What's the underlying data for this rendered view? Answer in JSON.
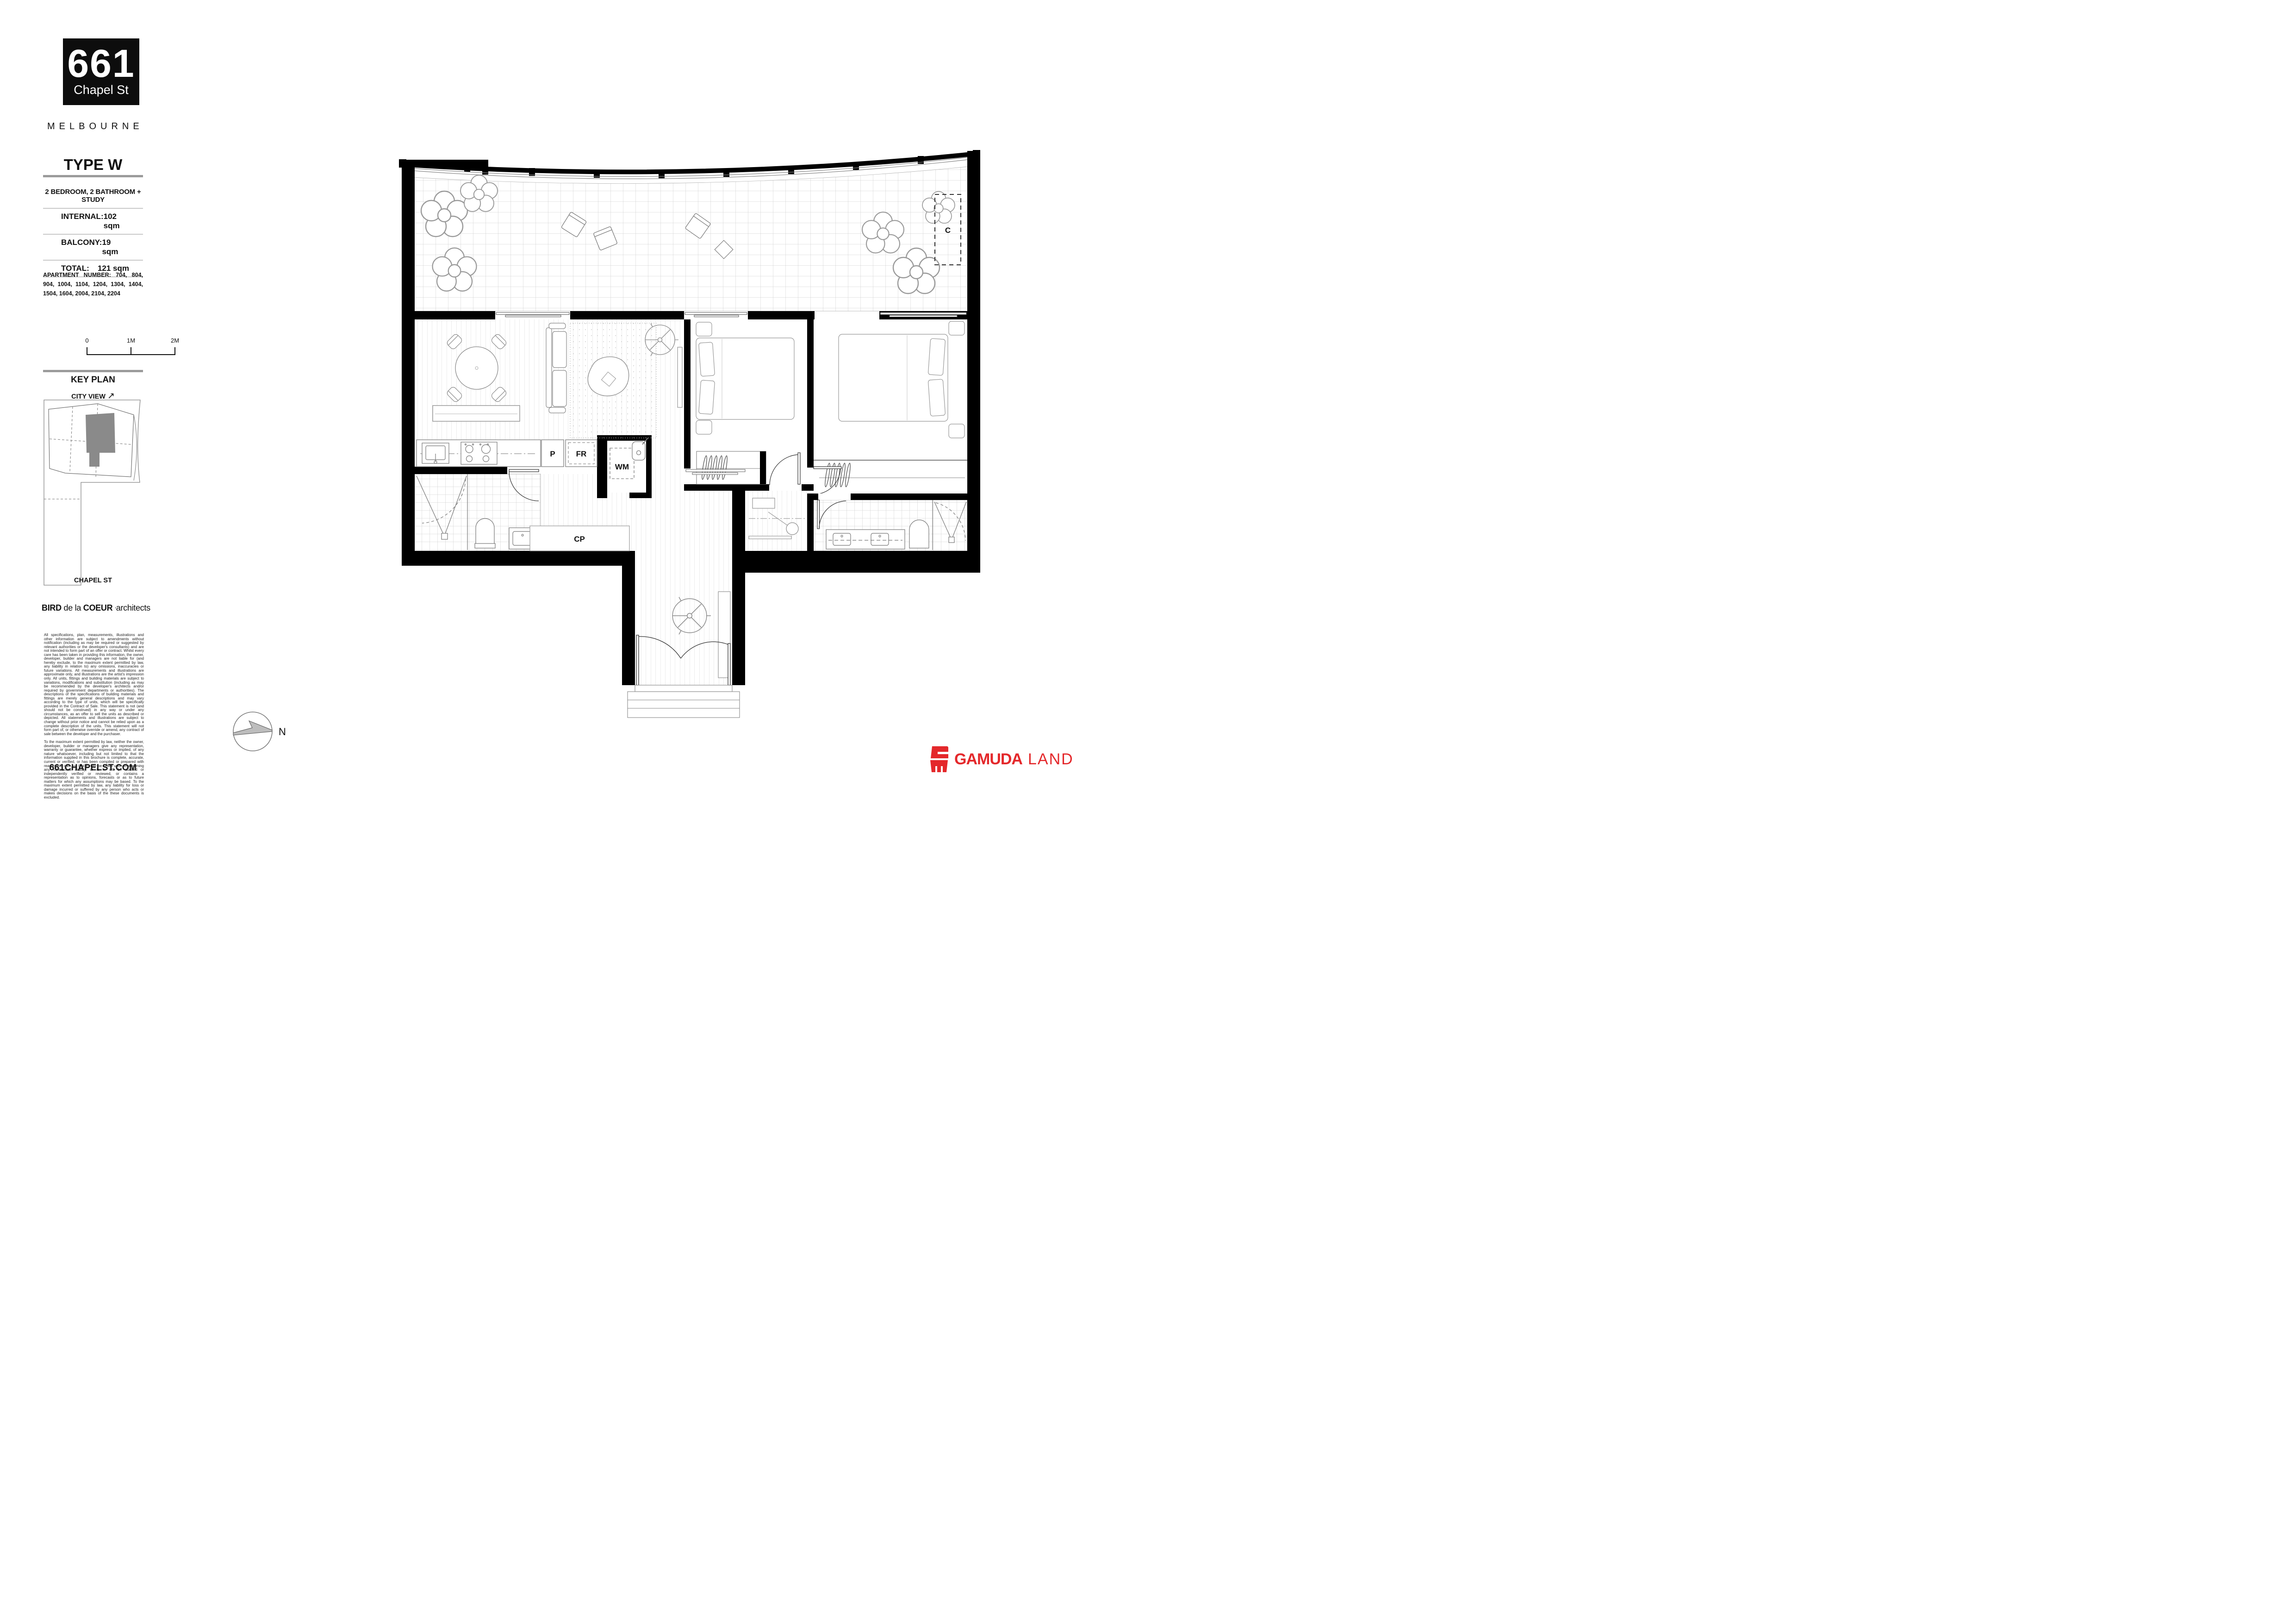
{
  "brand": {
    "number": "661",
    "street": "Chapel St",
    "city": "MELBOURNE"
  },
  "plan_info": {
    "type_title": "TYPE W",
    "config": "2 BEDROOM, 2 BATHROOM + STUDY",
    "areas": [
      {
        "label": "INTERNAL:",
        "value": "102 sqm"
      },
      {
        "label": "BALCONY:",
        "value": "19 sqm"
      },
      {
        "label": "TOTAL:",
        "value": "121 sqm"
      }
    ],
    "apartment_numbers": "APARTMENT NUMBER:  704, 804, 904, 1004, 1104, 1204, 1304, 1404, 1504, 1604, 2004, 2104, 2204"
  },
  "scale_bar": {
    "t0": "0",
    "t1": "1M",
    "t2": "2M"
  },
  "key_plan": {
    "title": "KEY PLAN",
    "city_view": "CITY VIEW",
    "arrow": "↗",
    "street": "CHAPEL ST"
  },
  "architect": {
    "w1": "BIRD",
    "w2": "de la",
    "w3": "COEUR",
    "mark": ",",
    "w4": "architects"
  },
  "disclaimer": {
    "p1": "All specifications, plan, measurements, illustrations and other information are subject to amendments without notification (including as may be required or suggested by relevant authorities or the developer's consultants) and are not intended to form part of an offer or contract. Whilst every care has been taken in providing this information, the owner, developer, builder and managers are not liable for (and hereby exclude, to the maximum extent permitted by law, any liability in relation to) any omissions, inaccuracies or future variations. All measurements and illustrations are approximate only, and illustrations are the artist's impression only. All units, fittings and building materials are subject to variations, modifications and substitution (including as may be recommended by the developer's architects and/or required by government departments or authorities). The descriptions of the specifications of building materials and fittings are merely general descriptions and may vary according to the type of units, which will be specifically provided in the Contract of Sale. This statement is not (and should not be construed) in any way or under any circumstances, as an offer to sell the units as described or depicted. All statements and illustrations are subject to change without prior notice and cannot be relied upon as a complete description of the units. This statement will not form part of, or otherwise override or amend, any contract of sale between the developer and the purchaser.",
    "p2": "To the maximum extent permitted by law, neither the owner, developer, builder or managers give any representation, warranty or guarantee, whether express or implied, of any nature whatsoever, including but not limited to that the information supplied in this brochure is complete, accurate, current or verified, or has been compiled or prepared with reasonable care, or that it may be relied upon in assuming any contractual liability, or is or will be audited or independently verified or reviewed, or contains a representation as to opinions, forecasts or as to future matters for which any assumptions may be based. To the maximum extent permitted by law, any liability for loss or damage incurred or suffered by any person who acts or makes decisions on the basis of the these documents is excluded."
  },
  "compass": {
    "label": "N"
  },
  "website": "661CHAPELST.COM",
  "developer": {
    "name_bold": "GAMUDA",
    "name_light": "LAND",
    "color": "#E4282B"
  },
  "floor_plan": {
    "labels": {
      "pantry": "P",
      "fridge": "FR",
      "washer": "WM",
      "cupboard": "CP",
      "condenser": "C"
    }
  },
  "colors": {
    "developer_red": "#E4282B",
    "divider_gray": "#9B9B9B",
    "keyplan_unit_gray": "#8A8A8A"
  }
}
